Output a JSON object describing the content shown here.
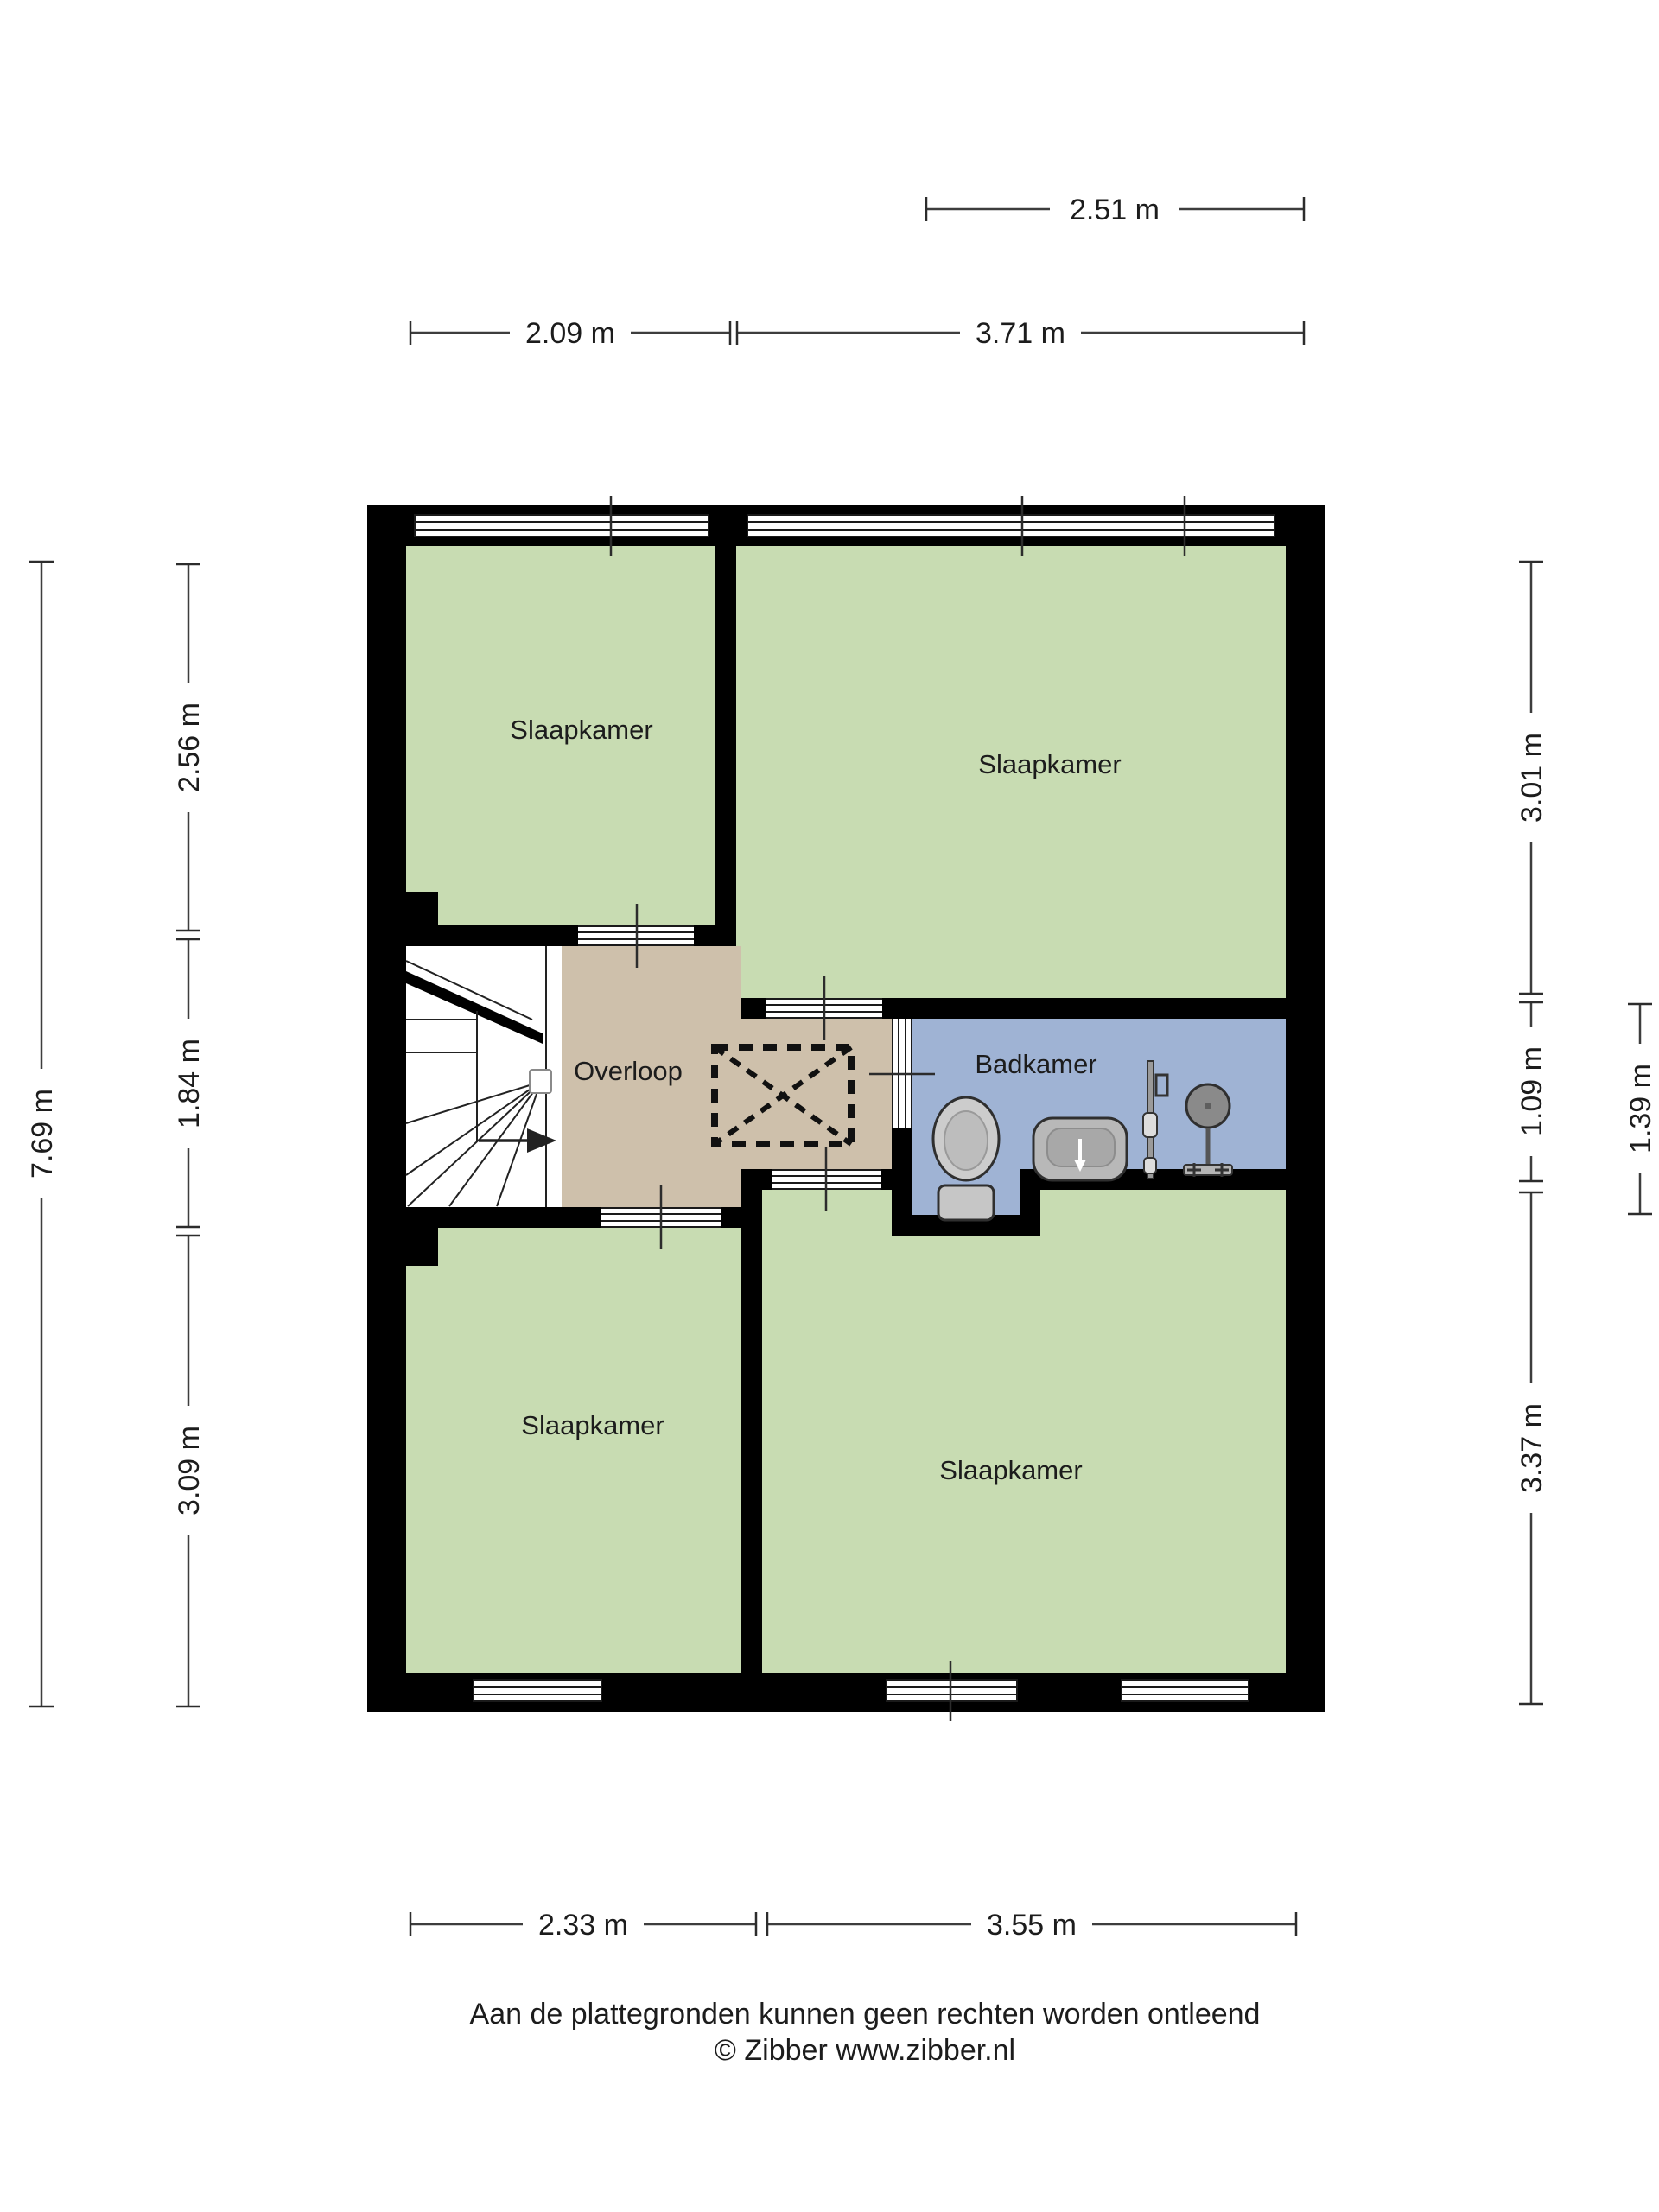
{
  "plan": {
    "type": "floorplan-upper-floor",
    "rooms": {
      "slaapkamer_tl": "Slaapkamer",
      "slaapkamer_tr": "Slaapkamer",
      "slaapkamer_bl": "Slaapkamer",
      "slaapkamer_br": "Slaapkamer",
      "overloop": "Overloop",
      "badkamer": "Badkamer"
    },
    "fixtures": [
      "toilet",
      "washbasin",
      "shower"
    ]
  },
  "dimensions": {
    "top_row1": "2.51 m",
    "top_row2_left": "2.09 m",
    "top_row2_right": "3.71 m",
    "left_outer": "7.69 m",
    "left_1": "2.56 m",
    "left_2": "1.84 m",
    "left_3": "3.09 m",
    "right_1": "3.01 m",
    "right_2": "1.09 m",
    "right_3": "3.37 m",
    "right_outer": "1.39 m",
    "bottom_left": "2.33 m",
    "bottom_right": "3.55 m"
  },
  "footer": {
    "disclaimer": "Aan de plattegronden kunnen geen rechten worden ontleend",
    "copyright": "© Zibber www.zibber.nl"
  },
  "colors": {
    "wall": "#000000",
    "bedroom_floor": "#c8dcb2",
    "landing_floor": "#cec0ab",
    "bathroom_floor": "#9fb3d4",
    "stairs_floor": "#ffffff",
    "background": "#ffffff"
  }
}
